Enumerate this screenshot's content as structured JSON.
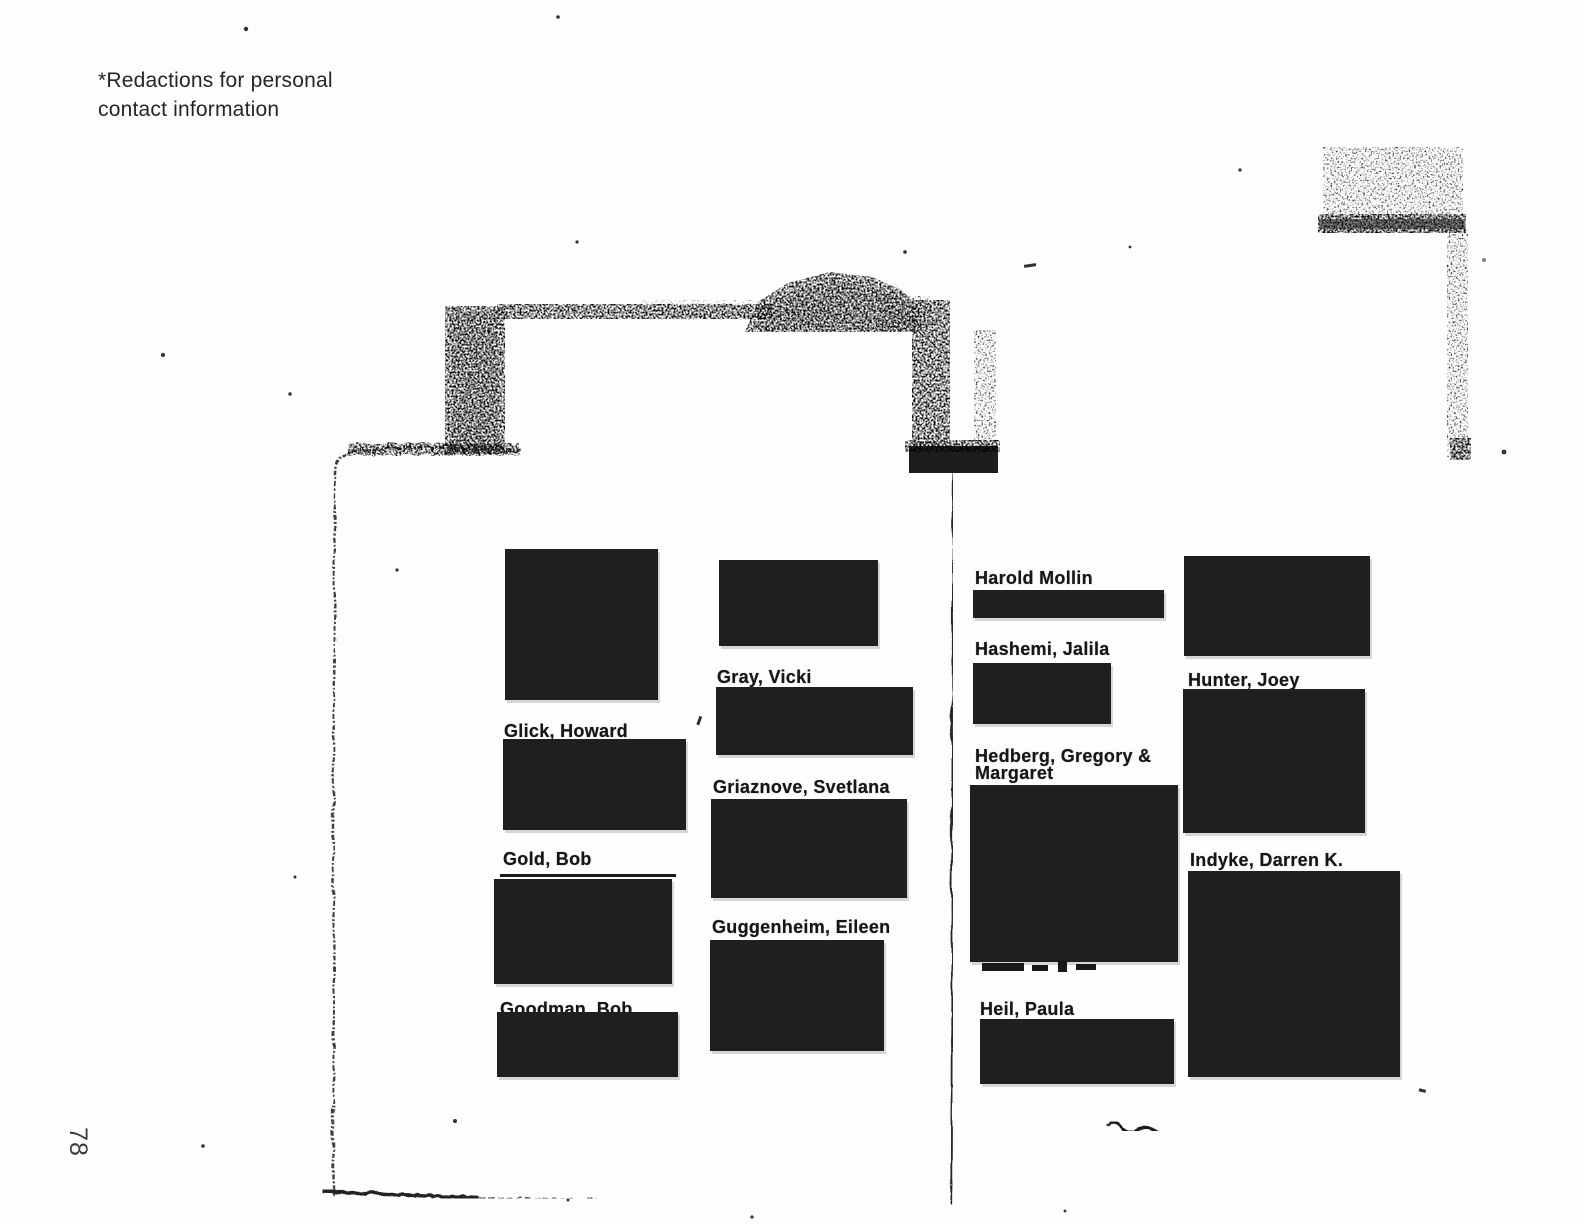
{
  "note": {
    "line1": "*Redactions for personal",
    "line2": "contact information"
  },
  "page_number": "78",
  "redaction_color": "#201f1f",
  "paper_color": "#fdfdfc",
  "directory": {
    "columns": [
      {
        "id": "left",
        "entries": [
          {
            "name": ""
          },
          {
            "name": "Glick, Howard"
          },
          {
            "name": "Gold, Bob"
          },
          {
            "name": "Goodman, Bob"
          }
        ]
      },
      {
        "id": "middle",
        "entries": [
          {
            "name": ""
          },
          {
            "name": "Gray, Vicki"
          },
          {
            "name": "Griaznove, Svetlana"
          },
          {
            "name": "Guggenheim, Eileen"
          }
        ]
      },
      {
        "id": "right",
        "entries": [
          {
            "name": "Harold Mollin"
          },
          {
            "name": "Hashemi, Jalila"
          },
          {
            "name": "Hedberg, Gregory &",
            "name_line2": "Margaret"
          },
          {
            "name": "Heil, Paula"
          }
        ]
      },
      {
        "id": "far-right",
        "entries": [
          {
            "name": ""
          },
          {
            "name": "Hunter, Joey"
          },
          {
            "name": "Indyke, Darren K."
          }
        ]
      }
    ]
  }
}
